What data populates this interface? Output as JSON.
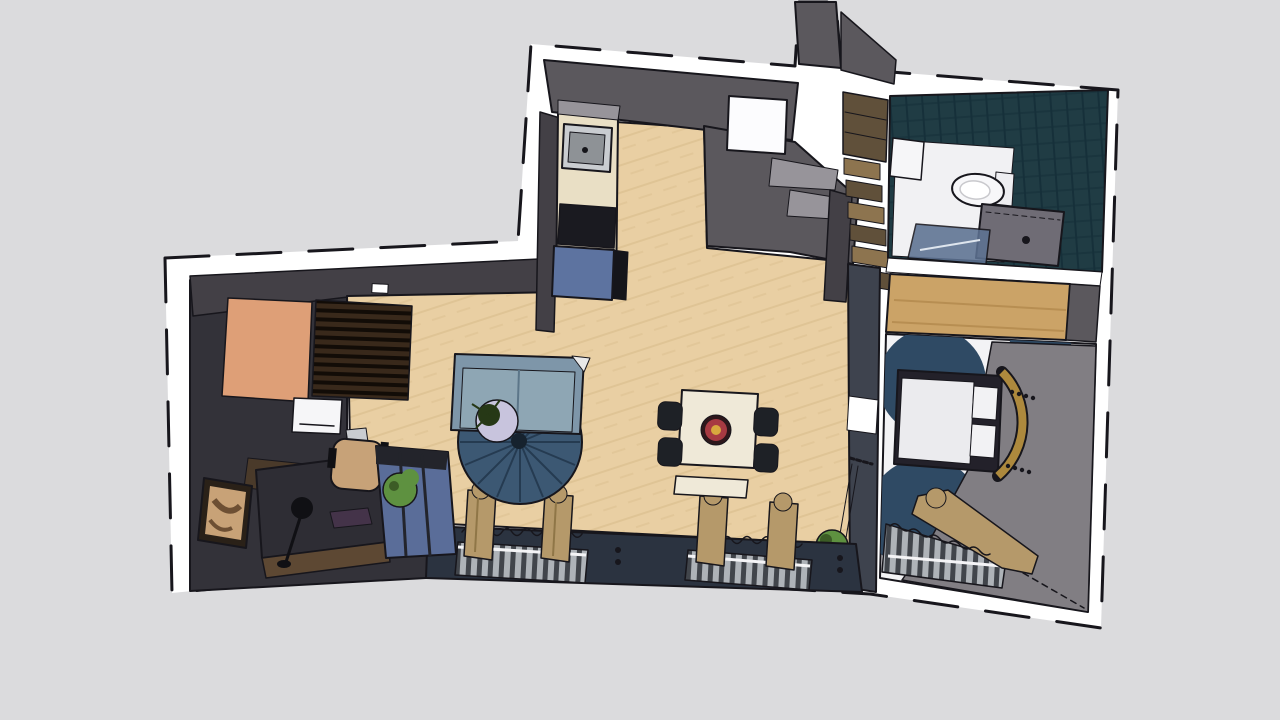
{
  "app": {
    "view": "top-down-3d-floor-plan-render",
    "background": "#dbdbdd"
  },
  "scene": {
    "rooms": [
      {
        "name": "kitchen"
      },
      {
        "name": "living-room"
      },
      {
        "name": "dining-area"
      },
      {
        "name": "entry-office-nook"
      },
      {
        "name": "stairwell"
      },
      {
        "name": "bathroom"
      },
      {
        "name": "bedroom"
      }
    ],
    "objects": [
      {
        "name": "kitchen-sink"
      },
      {
        "name": "cooktop"
      },
      {
        "name": "blue-cabinet"
      },
      {
        "name": "fridge"
      },
      {
        "name": "staircase"
      },
      {
        "name": "sofa"
      },
      {
        "name": "round-rug"
      },
      {
        "name": "side-table"
      },
      {
        "name": "dining-table"
      },
      {
        "name": "dining-chairs"
      },
      {
        "name": "centerpiece-bowl"
      },
      {
        "name": "window-radiators"
      },
      {
        "name": "curtains"
      },
      {
        "name": "desk"
      },
      {
        "name": "desk-lamp"
      },
      {
        "name": "laptop"
      },
      {
        "name": "office-chair"
      },
      {
        "name": "artwork"
      },
      {
        "name": "shelf-unit"
      },
      {
        "name": "potted-plant"
      },
      {
        "name": "hanging-plant"
      },
      {
        "name": "doormat"
      },
      {
        "name": "slatted-rack"
      },
      {
        "name": "washing-machine"
      },
      {
        "name": "toilet"
      },
      {
        "name": "vanity"
      },
      {
        "name": "shower-screen"
      },
      {
        "name": "wardrobe"
      },
      {
        "name": "bed"
      },
      {
        "name": "headboard"
      }
    ]
  },
  "colors": {
    "background": "#dbdbdd",
    "ink": "#17161c",
    "white": "#ffffff",
    "wall_gray": "#5b585d",
    "wall_gray_dark": "#434046",
    "wall_gray_light": "#817e83",
    "wall_slate": "#3e434e",
    "wall_navy": "#2b3340",
    "wall_brown": "#4a3a2a",
    "tile_teal": "#203c44",
    "tile_teal_dark": "#16303a",
    "floor_wood": "#e9cfa3",
    "floor_wood_line": "#dcbf8f",
    "floor_entry": "#333239",
    "bath_floor": "#f1f1f3",
    "bedroom_floor": "#f3f3f5",
    "bedroom_circle": "#2f4a64",
    "counter_cream": "#e9dfc5",
    "counter_gray": "#97949a",
    "steel_light": "#c9ccd0",
    "steel_dark": "#8e9296",
    "cooktop": "#1a1a20",
    "cabinet_blue": "#5d73a0",
    "shadow_black": "#15151a",
    "fridge_white": "#fcfcfe",
    "stair_wood": "#8d744f",
    "stair_wood_dark": "#60503a",
    "salmon": "#de9f77",
    "slat_brown": "#39291b",
    "slat_dark": "#120c07",
    "appliance_white": "#f6f6f8",
    "desk_dark": "#2e2d34",
    "desk_brown": "#5d4833",
    "art_tan": "#c8a277",
    "art_brown": "#6d4f33",
    "frame_dark": "#2a2118",
    "lamp_black": "#101014",
    "laptop_purple": "#443349",
    "chair_tan": "#c7a278",
    "shelf_blue": "#5a6d99",
    "shelf_dark": "#23242b",
    "plant_green": "#5e9140",
    "plant_dark": "#263816",
    "sofa_blue": "#7e96a9",
    "sofa_blue_light": "#8ea6b4",
    "sofa_line": "#5c7689",
    "blanket_white": "#e9e9e9",
    "rug_navy": "#3c5873",
    "rug_spoke": "#22364c",
    "rug_hub": "#16222e",
    "side_table": "#c8c4dd",
    "table_cream": "#efe9d8",
    "chair_black": "#1e2126",
    "bowl_dark": "#2d171b",
    "bowl_red": "#a73a42",
    "bowl_gold": "#d8a83e",
    "curtain_tan": "#b5996a",
    "curtain_fold": "#8f7647",
    "radiator_light": "#aeb3b8",
    "radiator_dark": "#41454b",
    "sill_white": "#f4f4f6",
    "vanity_gray": "#6f6c75",
    "shower_blue": "#5d7292",
    "shower_streak": "#dfe6ee",
    "toilet_white": "#f7f7f9",
    "tank_white": "#eeeef1",
    "wardrobe_wood": "#cba367",
    "wardrobe_grain": "#b78e52",
    "bed_frame": "#23212a",
    "mattress": "#ebebee",
    "pillow_white": "#f2f2f4",
    "brass": "#ad893d"
  }
}
